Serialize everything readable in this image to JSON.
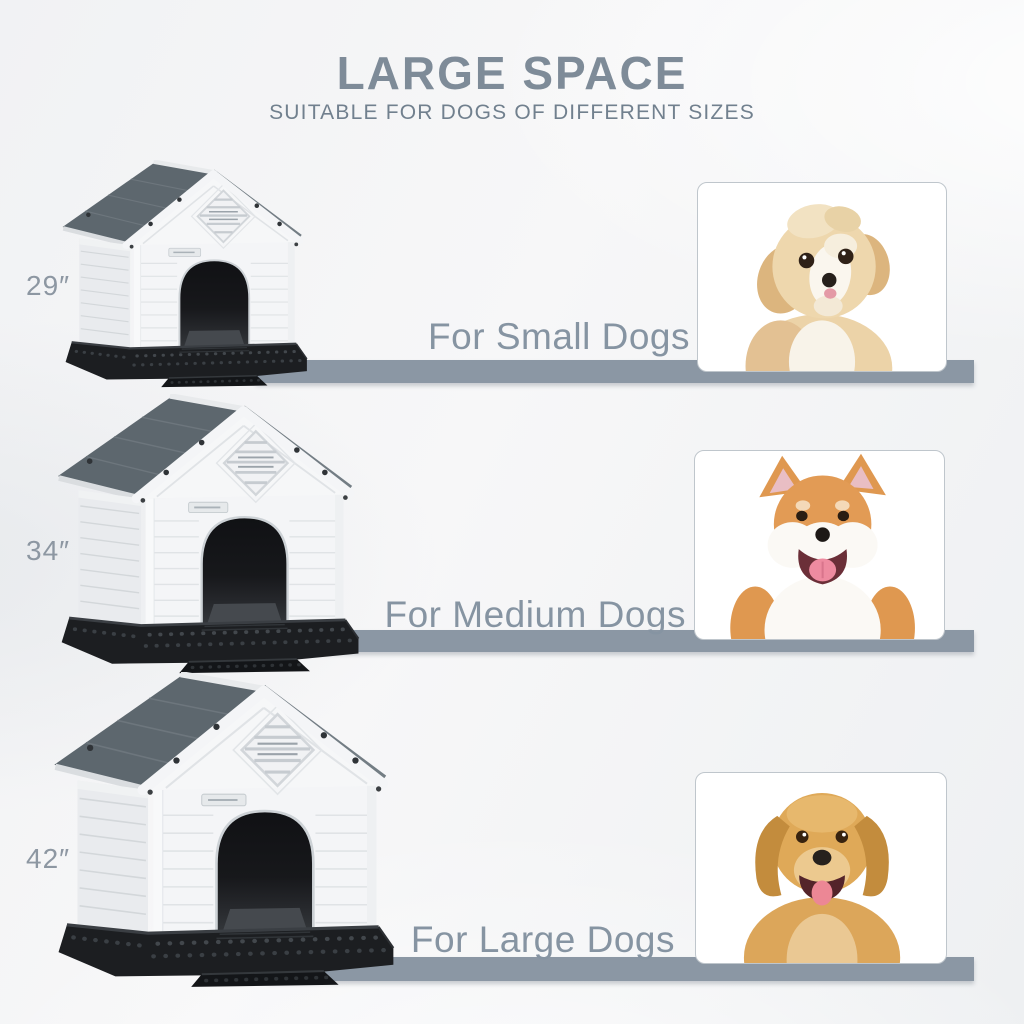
{
  "header": {
    "title": "LARGE SPACE",
    "subtitle": "SUITABLE FOR DOGS OF DIFFERENT SIZES"
  },
  "rows": [
    {
      "size_label": "29″",
      "caption": "For Small Dogs",
      "dog_illustration": "havanese-puppy"
    },
    {
      "size_label": "34″",
      "caption": "For Medium Dogs",
      "dog_illustration": "shiba-inu"
    },
    {
      "size_label": "42″",
      "caption": "For Large Dogs",
      "dog_illustration": "golden-retriever"
    }
  ],
  "colors": {
    "title_text": "#7e8b98",
    "subtitle_text": "#71808e",
    "caption_text": "#8694a2",
    "size_label_text": "#8d97a2",
    "divider_bar": "#8b97a4",
    "card_border": "#bfc6cc",
    "house_roof": "#5d676e",
    "house_body": "#f4f5f7",
    "house_base": "#1c1e21"
  }
}
